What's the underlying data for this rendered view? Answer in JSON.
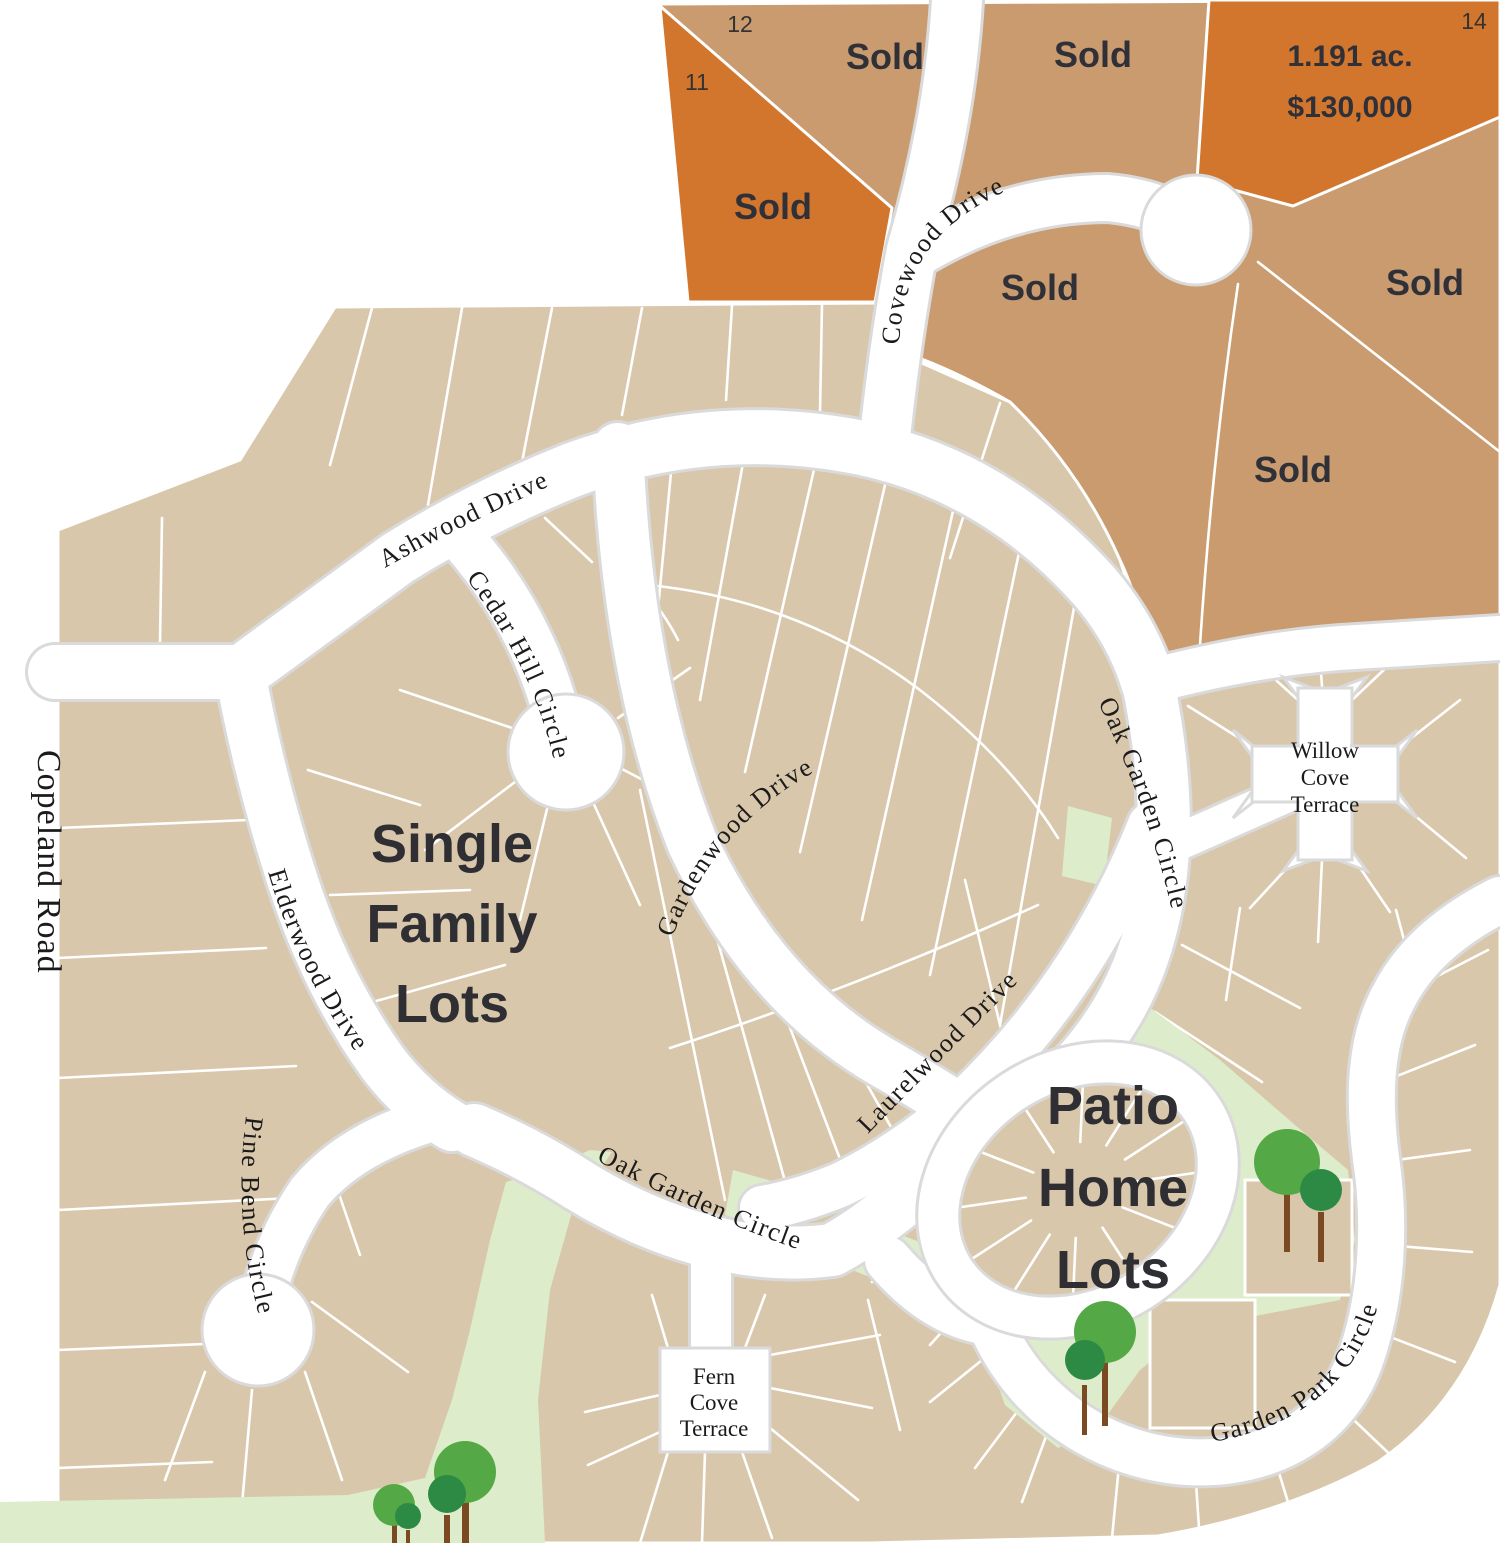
{
  "map": {
    "region_labels": {
      "single_family": [
        "Single",
        "Family",
        "Lots"
      ],
      "patio_home": [
        "Patio",
        "Home",
        "Lots"
      ]
    },
    "streets": {
      "copeland_road": "Copeland Road",
      "ashwood_drive": "Ashwood Drive",
      "cedar_hill_circle": "Cedar Hill Circle",
      "covewood_drive": "Covewood Drive",
      "gardenwood_drive": "Gardenwood Drive",
      "elderwood_drive": "Elderwood Drive",
      "pine_bend_circle": "Pine Bend Circle",
      "oak_garden_circle": "Oak Garden Circle",
      "laurelwood_drive": "Laurelwood Drive",
      "garden_park_circle": "Garden Park Circle"
    },
    "courts": {
      "willow_cove": [
        "Willow",
        "Cove",
        "Terrace"
      ],
      "fern_cove": [
        "Fern",
        "Cove",
        "Terrace"
      ]
    },
    "lots": {
      "sold_label": "Sold",
      "numbers": {
        "lot_11": "11",
        "lot_12": "12",
        "lot_14": "14"
      },
      "featured_lot": {
        "acreage": "1.191 ac.",
        "price": "$130,000"
      }
    },
    "colors": {
      "lot_available_light": "#D9C7AB",
      "lot_sold_tan": "#CA9B6E",
      "lot_premium_orange": "#D2762E",
      "green_space": "#DDEDCB",
      "tree_canopy_light": "#54A845",
      "tree_canopy_dark": "#2D8A45",
      "tree_trunk": "#7B4A22",
      "road": "#FFFFFF",
      "road_casing": "#DADADA",
      "label_text": "#2E2E33"
    }
  }
}
